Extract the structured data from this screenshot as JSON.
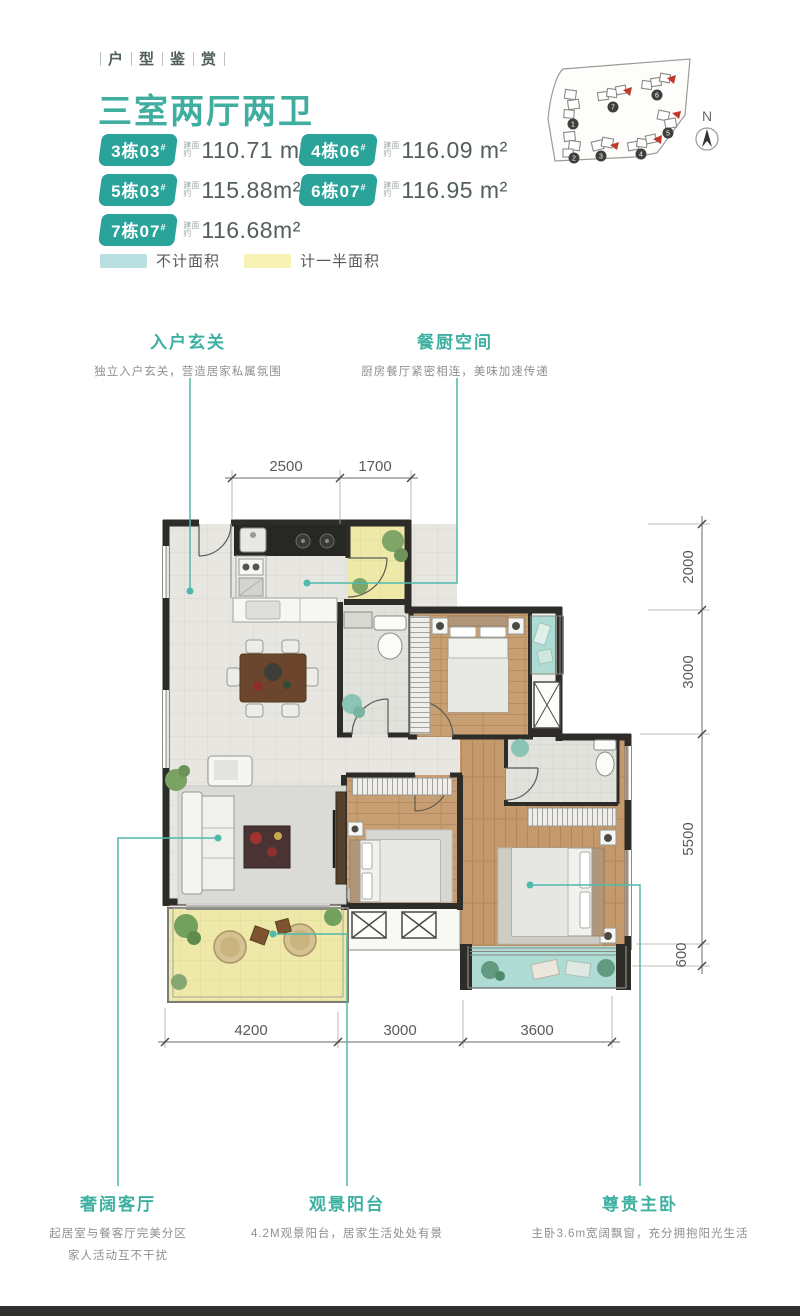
{
  "header": {
    "eyebrow": [
      "户",
      "型",
      "鉴",
      "赏"
    ],
    "title": "三室两厅两卫",
    "area_prefix": "建面约",
    "units": [
      {
        "badge": "3栋03",
        "sup": "#",
        "area": "110.71 m²"
      },
      {
        "badge": "4栋06",
        "sup": "#",
        "area": "116.09 m²"
      },
      {
        "badge": "5栋03",
        "sup": "#",
        "area": "115.88m²"
      },
      {
        "badge": "6栋07",
        "sup": "#",
        "area": "116.95 m²"
      },
      {
        "badge": "7栋07",
        "sup": "#",
        "area": "116.68m²"
      }
    ]
  },
  "legend": {
    "items": [
      {
        "label": "不计面积",
        "color": "#b9dfe1"
      },
      {
        "label": "计一半面积",
        "color": "#f8f2b6"
      }
    ]
  },
  "site_map": {
    "north_label": "N",
    "building_numbers": [
      "1",
      "2",
      "3",
      "4",
      "5",
      "6",
      "7"
    ],
    "highlight_color": "#c0392b"
  },
  "callouts_top": [
    {
      "title": "入户玄关",
      "desc": "独立入户玄关，营造居家私属氛围"
    },
    {
      "title": "餐厨空间",
      "desc": "厨房餐厅紧密相连，美味加速传递"
    }
  ],
  "callouts_bottom": [
    {
      "title": "奢阔客厅",
      "lines": [
        "起居室与餐客厅完美分区",
        "家人活动互不干扰"
      ]
    },
    {
      "title": "观景阳台",
      "lines": [
        "4.2M观景阳台，居家生活处处有景"
      ]
    },
    {
      "title": "尊贵主卧",
      "lines": [
        "主卧3.6m宽阔飘窗，充分拥抱阳光生活"
      ]
    }
  ],
  "dimensions": {
    "top": [
      "2500",
      "1700"
    ],
    "right": [
      "2000",
      "3000",
      "5500",
      "600"
    ],
    "bottom": [
      "4200",
      "3000",
      "3600"
    ]
  },
  "colors": {
    "accent": "#3fae9f",
    "badge": "#2aa39a",
    "wall": "#2e2c28",
    "leader": "#4fb9ac",
    "half_area_yellow": "#eee8a9",
    "no_count_teal": "#aedcd4"
  }
}
